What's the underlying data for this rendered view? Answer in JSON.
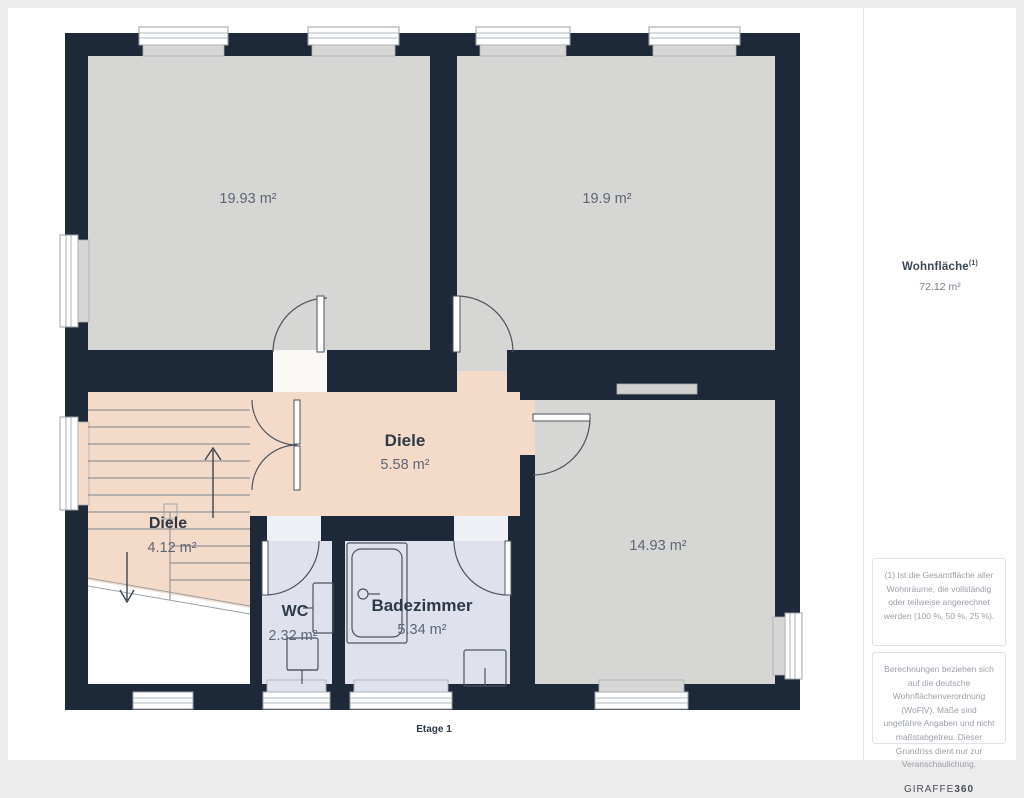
{
  "page": {
    "floor_label": "Etage 1"
  },
  "rooms": {
    "room_top_left": {
      "area": "19.93 m²"
    },
    "room_top_right": {
      "area": "19.9 m²"
    },
    "hall_main": {
      "name": "Diele",
      "area": "5.58 m²"
    },
    "hall_stairs": {
      "name": "Diele",
      "area": "4.12 m²"
    },
    "wc": {
      "name": "WC",
      "area": "2.32 m²"
    },
    "bathroom": {
      "name": "Badezimmer",
      "area": "5.34 m²"
    },
    "room_right": {
      "area": "14.93 m²"
    }
  },
  "sidebar": {
    "total_label": "Wohnfläche",
    "total_footnote_marker": "(1)",
    "total_value": "72.12 m²",
    "footnote_1": "(1) Ist die Gesamtfläche aller Wohnräume, die vollständig oder teilweise angerechnet werden (100 %, 50 %, 25 %).",
    "footnote_2": "Berechnungen beziehen sich auf die deutsche Wohnflächenverordnung (WoFlV). Maße sind ungefähre Angaben und nicht maßstabgetreu. Dieser Grundriss dient nur zur Veranschaulichung.",
    "brand_name": "GIRAFFE",
    "brand_suffix": "360"
  },
  "colors": {
    "wall": "#1d2838",
    "floor_room": "#d6d6d4",
    "floor_hall": "#f4dbc9",
    "floor_bath": "#dfe2ed",
    "page_frame": "#ececec"
  }
}
